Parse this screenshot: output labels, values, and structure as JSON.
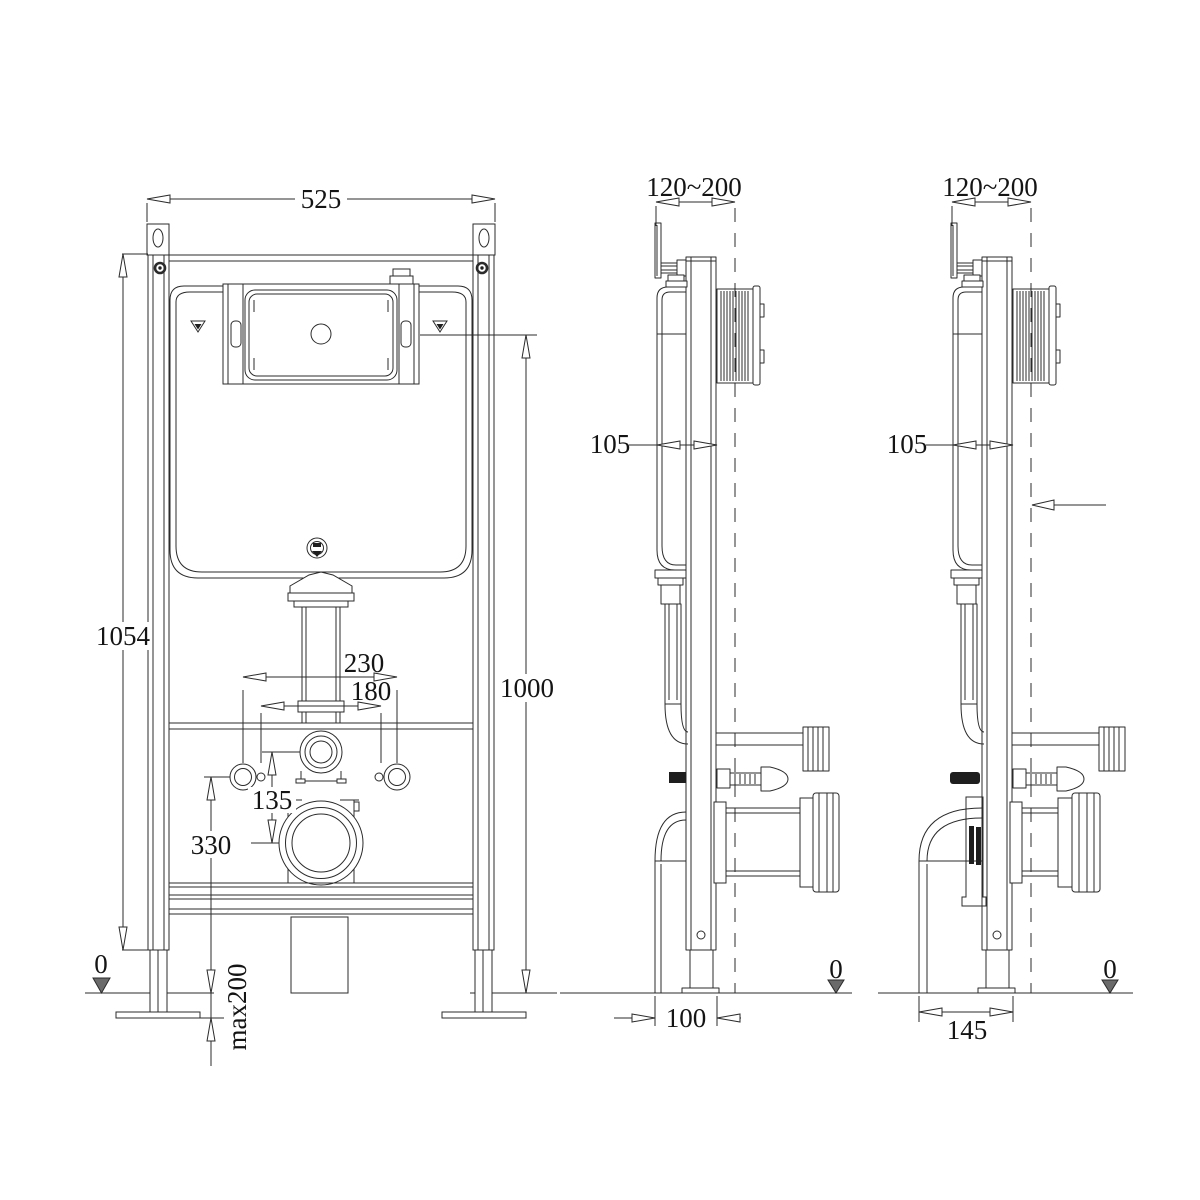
{
  "front": {
    "width": "525",
    "height": "1054",
    "plate_center_height": "1000",
    "fixing_spacing_outer": "230",
    "fixing_spacing_inner": "180",
    "supply_to_drain": "135",
    "drain_center_height": "330",
    "leg_adjustment": "max200",
    "floor_datum": "0"
  },
  "side_middle": {
    "wall_clearance": "120~200",
    "frame_depth": "105",
    "base_depth": "100",
    "floor_datum": "0"
  },
  "side_right": {
    "wall_clearance": "120~200",
    "frame_depth": "105",
    "base_depth": "145",
    "floor_datum": "0"
  }
}
